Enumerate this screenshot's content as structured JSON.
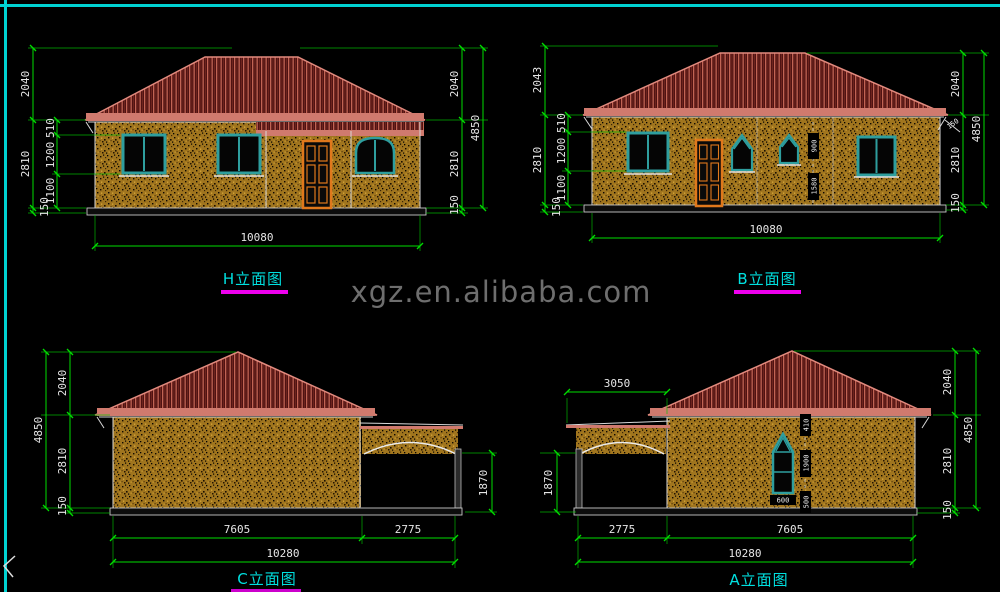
{
  "canvas": {
    "background": "#000000",
    "border_color": "#00d2d2"
  },
  "watermark": {
    "text": "xgz.en.alibaba.com",
    "color": "#6e6e6e"
  },
  "colors": {
    "dimension_line": "#00dd00",
    "dimension_text": "#e6e6e6",
    "title_text": "#00e0e0",
    "title_underline": "#ee00ee",
    "roof_base": "#4f1212",
    "roof_stripe": "#c26454",
    "fascia": "#d07a6e",
    "wall": "#a0751e",
    "window_frame": "#2e9e9e",
    "door_frame": "#e0781c"
  },
  "elevations": {
    "h": {
      "title": "H立面图",
      "dims": {
        "left_outer": [
          "2040",
          "2810",
          "150"
        ],
        "left_inner": [
          "510",
          "1200",
          "1100"
        ],
        "right_inner": [
          "2040",
          "2810",
          "150"
        ],
        "right_outer": "4850",
        "bottom": "10080"
      }
    },
    "b": {
      "title": "B立面图",
      "dims": {
        "left_outer": [
          "2043",
          "2810",
          "150"
        ],
        "left_inner": [
          "510",
          "1200",
          "1100"
        ],
        "right_inner": [
          "2040",
          "2810",
          "150"
        ],
        "right_outer": "4850",
        "bottom": "10080",
        "mid": [
          "900",
          "1580"
        ],
        "eave_overhang": "150"
      }
    },
    "c": {
      "title": "C立面图",
      "dims": {
        "left_outer": "4850",
        "left_inner": [
          "2040",
          "2810",
          "150"
        ],
        "opening_height": "1870",
        "bottom_row1": [
          "7605",
          "2775"
        ],
        "bottom_total": "10280"
      }
    },
    "a": {
      "title": "A立面图",
      "dims": {
        "porch_width": "3050",
        "opening_height": "1870",
        "right_inner": [
          "2040",
          "2810",
          "150"
        ],
        "right_outer": "4850",
        "window": {
          "top_offset": "410",
          "height": "1900",
          "sill": "500",
          "width": "600"
        },
        "bottom_row1": [
          "2775",
          "7605"
        ],
        "bottom_total": "10280"
      }
    }
  }
}
